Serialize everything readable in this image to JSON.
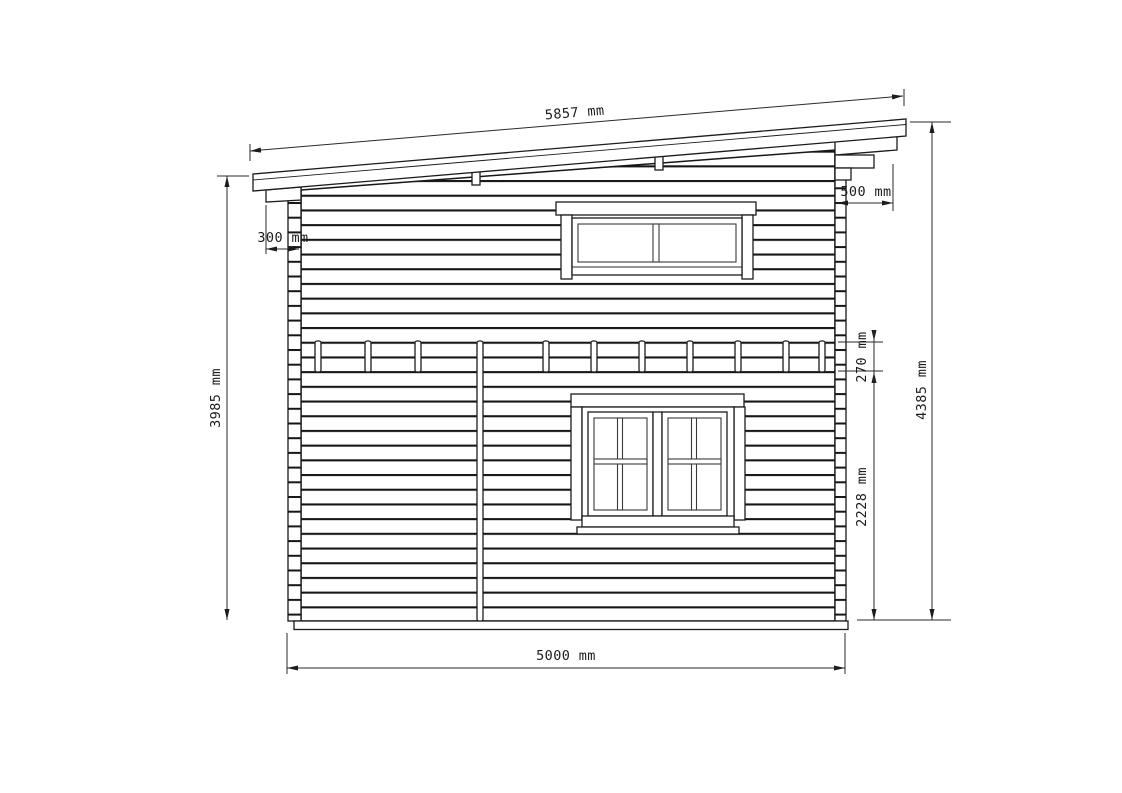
{
  "drawing": {
    "type": "technical-elevation",
    "background": "#ffffff",
    "line_color": "#1c1c1c",
    "dimensions": {
      "roof_length": "5857 mm",
      "overhang_left": "300 mm",
      "overhang_right": "500 mm",
      "height_left": "3985 mm",
      "height_right": "4385 mm",
      "top_band": "270 mm",
      "lower_section": "2228 mm",
      "width": "5000 mm"
    }
  }
}
